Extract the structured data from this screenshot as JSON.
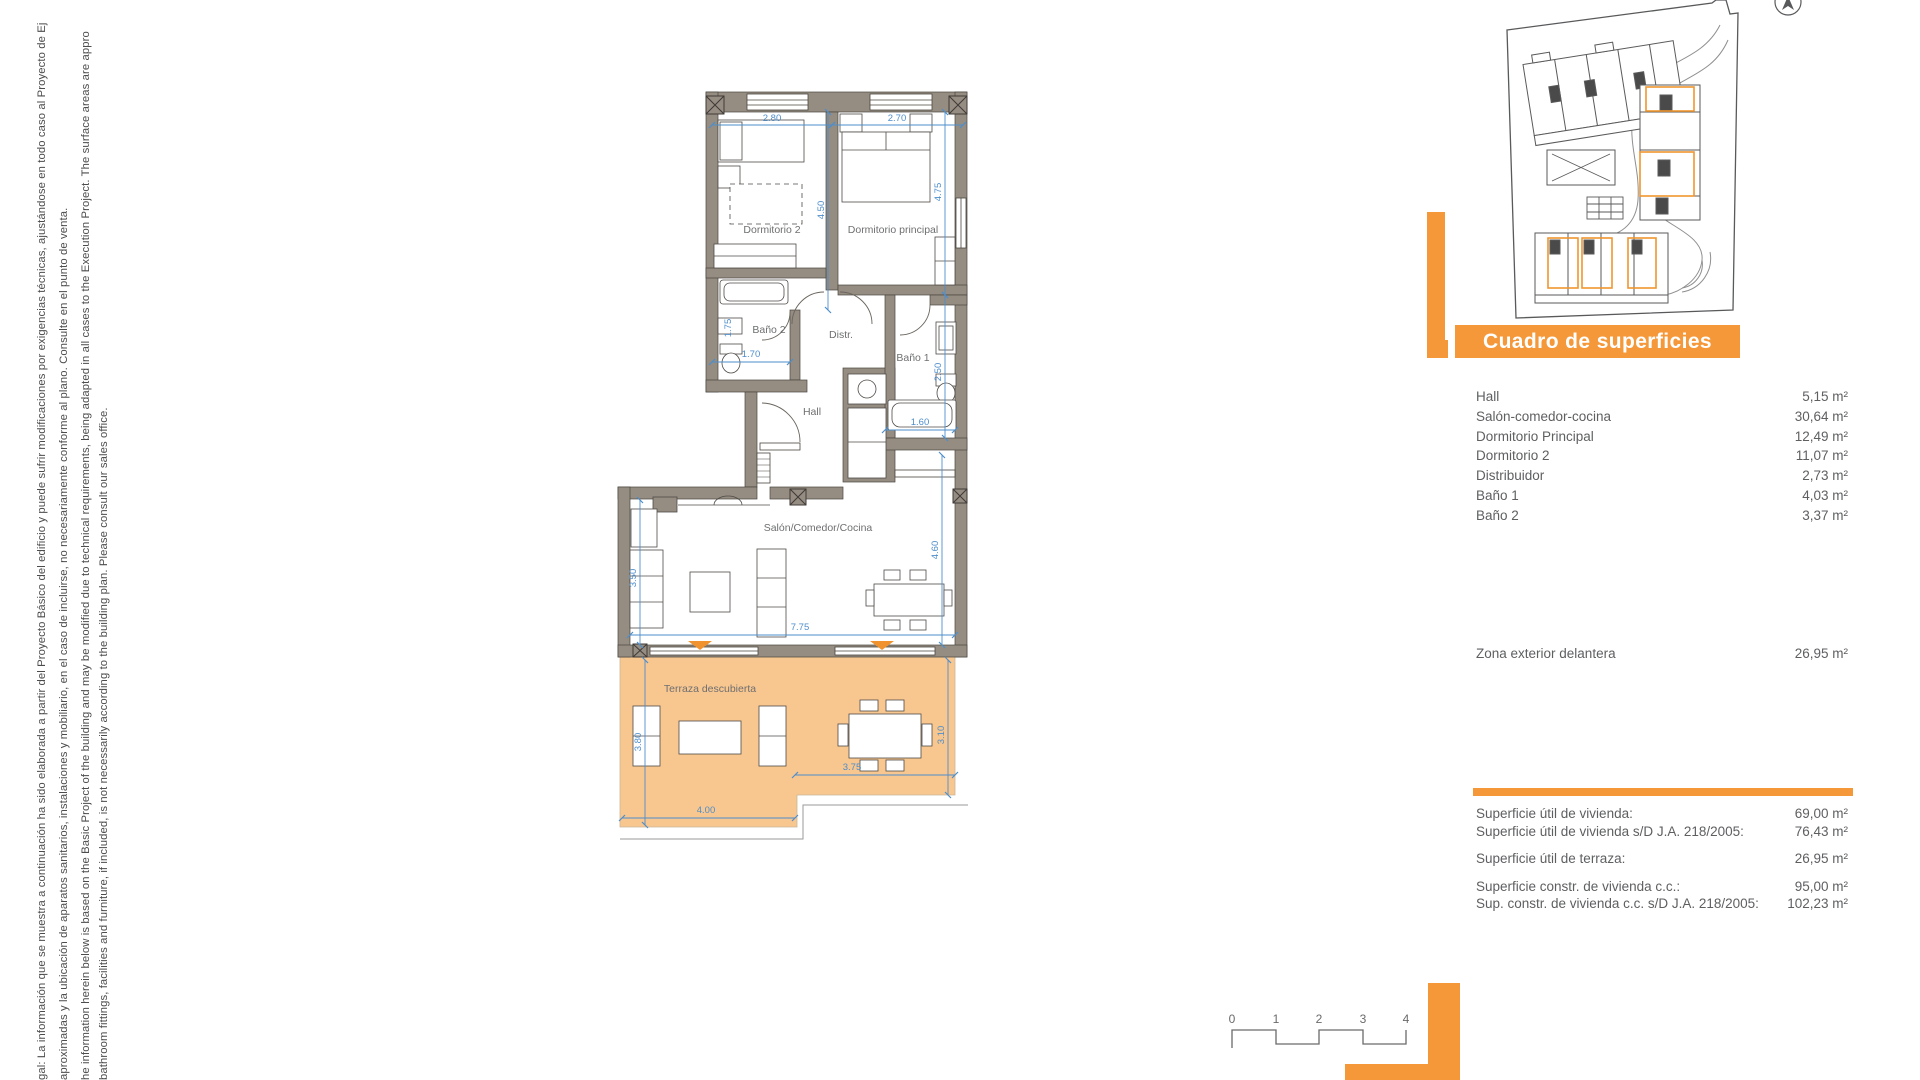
{
  "disclaimer": {
    "lines": [
      "gal: La información que se muestra a continuación ha sido elaborada a partir del Proyecto Básico del edificio y puede sufrir modificaciones por exigencias técnicas, ajustándose en todo caso al Proyecto de Ej",
      "aproximadas y la ubicación de aparatos sanitarios, instalaciones y mobiliario, en el caso de incluirse, no necesariamente conforme al plano. Consulte en el punto de venta.",
      "he information herein below is based on the Basic Project of the building and may be modified due to technical requirements, being adapted in all cases to the Execution Project. The surface areas are appro",
      "bathroom fittings, facilities and furniture, if included, is not necessarily according to the building plan. Please consult our sales office."
    ]
  },
  "floor_plan": {
    "rooms": {
      "dormitorio2": "Dormitorio 2",
      "dormitorio_principal": "Dormitorio principal",
      "bano2": "Baño 2",
      "distribuidor": "Distr.",
      "bano1": "Baño 1",
      "hall": "Hall",
      "salon": "Salón/Comedor/Cocina",
      "terraza": "Terraza descubierta"
    },
    "dimensions": {
      "dorm2_width": "2.80",
      "dormp_width": "2.70",
      "dorm2_depth": "4.50",
      "dormp_depth": "4.75",
      "bano2_width": "1.70",
      "bano2_niche": "1.75",
      "bano1_width": "1.60",
      "bano1_depth": "2.50",
      "salon_left": "3.50",
      "salon_width": "7.75",
      "salon_right": "4.60",
      "terraza_left": "3.80",
      "terraza_width_left": "4.00",
      "terraza_width_right": "3.75",
      "terraza_right": "3.10"
    }
  },
  "surfaces": {
    "title": "Cuadro de superficies",
    "rows": [
      {
        "label": "Hall",
        "value": "5,15 m²"
      },
      {
        "label": "Salón-comedor-cocina",
        "value": "30,64 m²"
      },
      {
        "label": "Dormitorio Principal",
        "value": "12,49 m²"
      },
      {
        "label": "Dormitorio 2",
        "value": "11,07 m²"
      },
      {
        "label": "Distribuidor",
        "value": "2,73 m²"
      },
      {
        "label": "Baño 1",
        "value": "4,03 m²"
      },
      {
        "label": "Baño 2",
        "value": "3,37 m²"
      }
    ],
    "exterior": {
      "label": "Zona exterior delantera",
      "value": "26,95 m²"
    },
    "totals": [
      {
        "label": "Superficie útil de vivienda:",
        "value": "69,00 m²"
      },
      {
        "label": "Superficie útil de vivienda s/D J.A. 218/2005:",
        "value": "76,43 m²"
      },
      {
        "label": "Superficie útil de terraza:",
        "value": "26,95 m²"
      },
      {
        "label": "Superficie constr. de vivienda c.c.:",
        "value": "95,00 m²"
      },
      {
        "label": "Sup. constr. de vivienda c.c. s/D J.A. 218/2005:",
        "value": "102,23 m²"
      }
    ]
  },
  "scale_bar": {
    "labels": [
      "0",
      "1",
      "2",
      "3",
      "4"
    ]
  },
  "colors": {
    "accent_orange": "#F5983A",
    "terrace_fill": "#F8C68F",
    "wall_fill": "#958C82",
    "dimension_blue": "#4E8ECB"
  }
}
